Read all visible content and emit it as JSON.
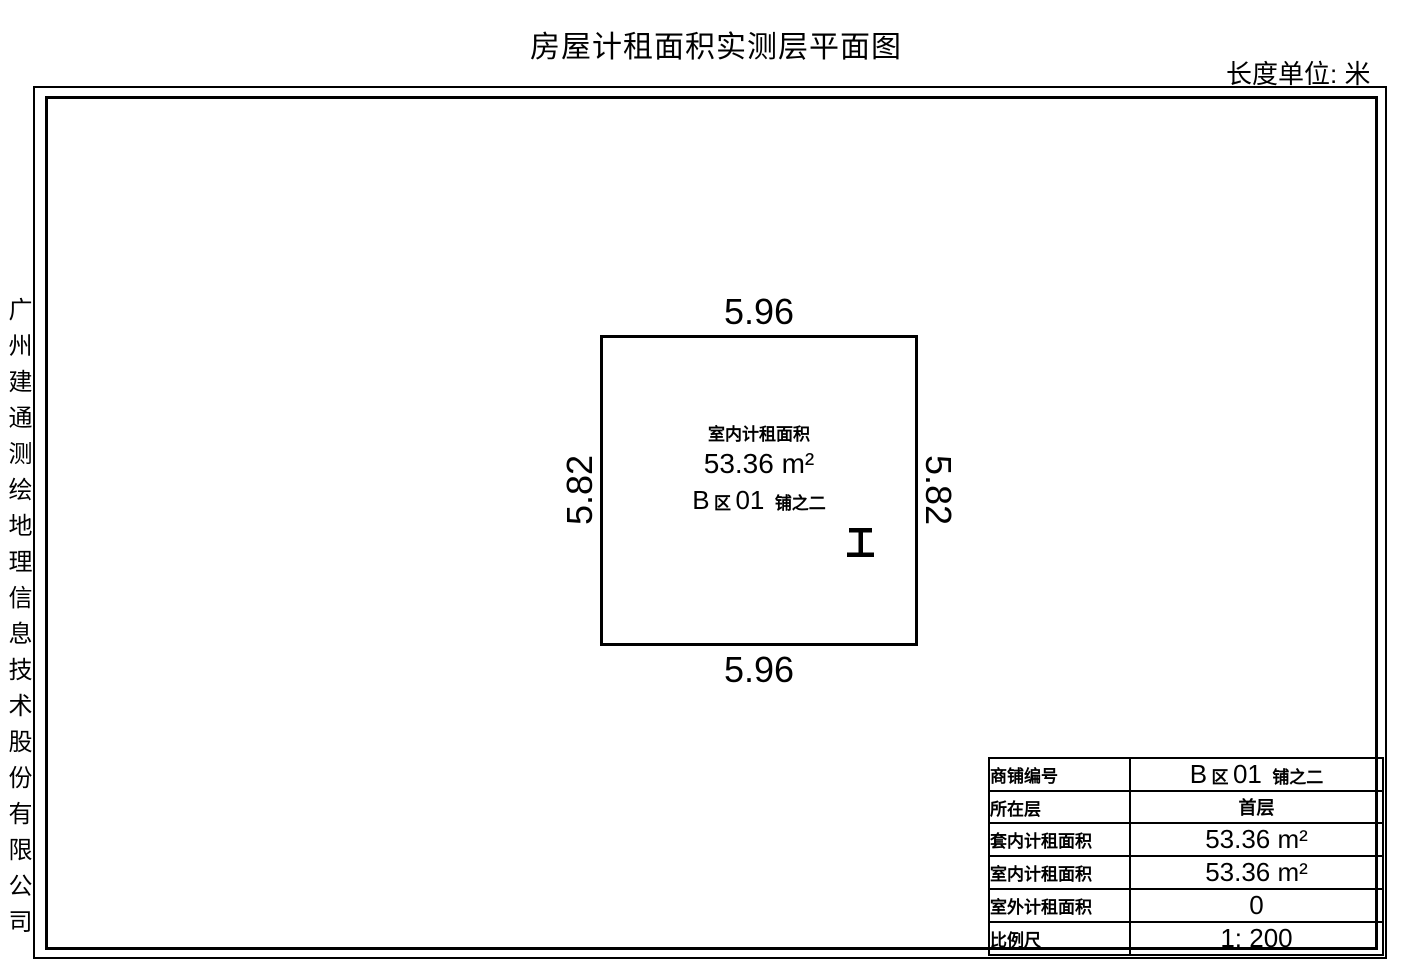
{
  "header": {
    "title": "房屋计租面积实测层平面图",
    "unit_label": "长度单位: 米"
  },
  "company": {
    "name": "广州建通测绘地理信息技术股份有限公司"
  },
  "room": {
    "area_label": "室内计租面积",
    "area_value": "53.36 m²",
    "dim_top": "5.96",
    "dim_bottom": "5.96",
    "dim_left": "5.82",
    "dim_right": "5.82"
  },
  "shop_id": {
    "full": "B区01铺之二",
    "part_latin_b": "B",
    "part_cjk_qu": "区",
    "part_latin_num": "01",
    "part_cjk_suffix": "铺之二"
  },
  "info_table": {
    "rows": [
      {
        "label": "商铺编号",
        "value": "B区01铺之二"
      },
      {
        "label": "所在层",
        "value": "首层"
      },
      {
        "label": "套内计租面积",
        "value": "53.36 m²"
      },
      {
        "label": "室内计租面积",
        "value": "53.36 m²"
      },
      {
        "label": "室外计租面积",
        "value": "0"
      },
      {
        "label": "比例尺",
        "value": "1: 200"
      }
    ]
  },
  "colors": {
    "line": "#000000",
    "background": "#ffffff"
  }
}
